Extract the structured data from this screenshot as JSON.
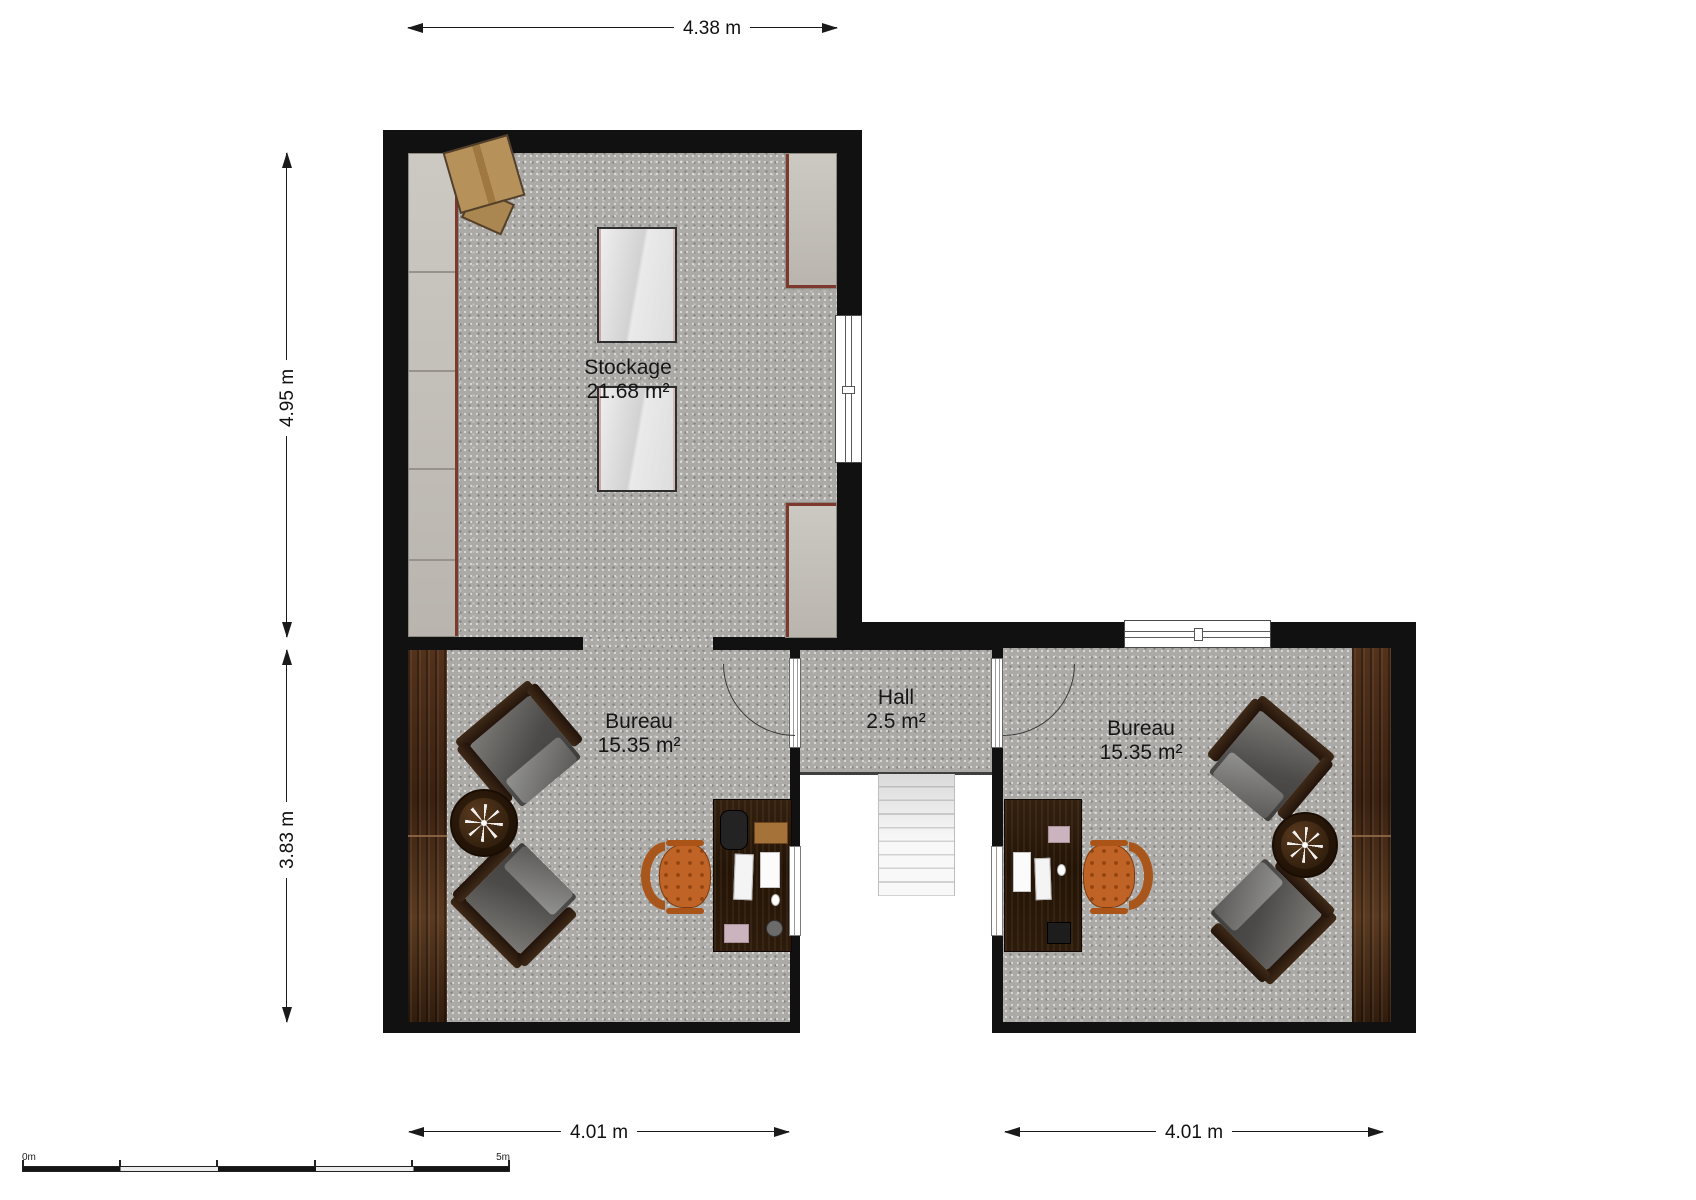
{
  "plan": {
    "title": "Floor plan — upper storey with storage room, two offices and hall",
    "rooms": [
      {
        "name": "Stockage",
        "area": "21.68 m²"
      },
      {
        "name": "Bureau",
        "area": "15.35 m²"
      },
      {
        "name": "Hall",
        "area": "2.5 m²"
      },
      {
        "name": "Bureau",
        "area": "15.35 m²"
      }
    ],
    "dimensions": {
      "top_width": "4.38 m",
      "upper_left_height": "4.95 m",
      "lower_left_height": "3.83 m",
      "bottom_left_width": "4.01 m",
      "bottom_right_width": "4.01 m"
    },
    "scale_bar": {
      "start_label": "0m",
      "end_label": "5m"
    },
    "colors": {
      "wall": "#111111",
      "floor_speckle": "#abaaa7",
      "counter": "#c5c2bc",
      "counter_accent": "#7d392e",
      "wood_panel": "#46290f",
      "desk_wood": "#2a1708",
      "armchair_gray": "#55544f",
      "office_chair_orange": "#bf6426",
      "cardboard": "#b6915a",
      "outside": "#ffffff"
    },
    "furniture_icons": [
      "cardboard-box",
      "storage-table",
      "wall-cabinet",
      "counter",
      "armchair",
      "round-side-table",
      "desk",
      "office-chair",
      "staircase",
      "door-swing",
      "window",
      "stair-railing",
      "wood-paneling"
    ]
  }
}
